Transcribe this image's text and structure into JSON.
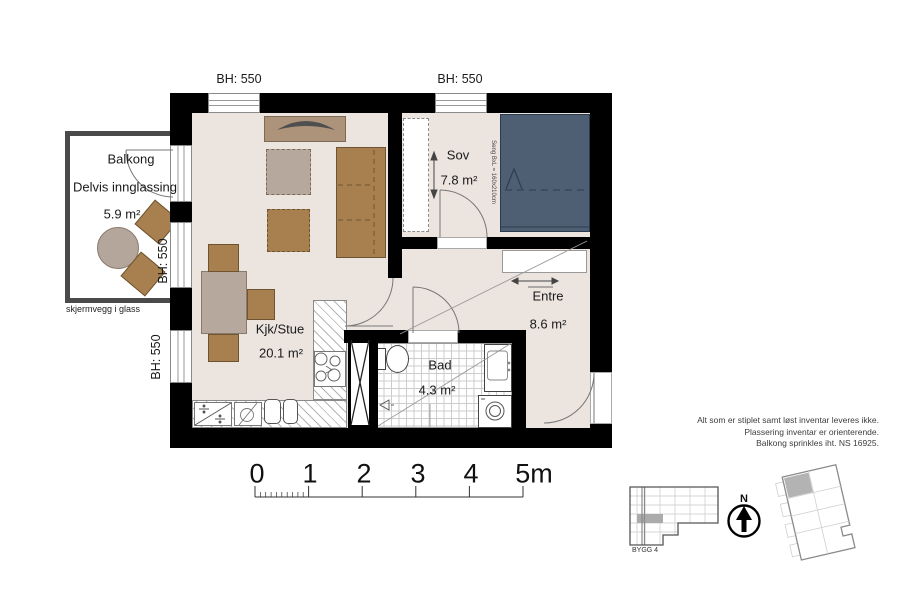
{
  "rooms": {
    "balkong": {
      "name": "Balkong",
      "detail": "Delvis innglassing",
      "area": "5.9 m²"
    },
    "sov": {
      "name": "Sov",
      "area": "7.8 m²"
    },
    "kjk_stue": {
      "name": "Kjk/Stue",
      "area": "20.1 m²"
    },
    "entre": {
      "name": "Entre",
      "area": "8.6 m²"
    },
    "bad": {
      "name": "Bad",
      "area": "4.3 m²"
    }
  },
  "labels": {
    "bh_window_top_left": "BH: 550",
    "bh_window_top_right": "BH: 550",
    "bh_balcony_door": "BH: 550",
    "bh_window_left": "BH: 550",
    "screen_wall": "skjermvegg i glass",
    "bed_size": "Seng BxL = 160x210cm"
  },
  "scale_bar": {
    "ticks": [
      "0",
      "1",
      "2",
      "3",
      "4",
      "5m"
    ]
  },
  "notes": {
    "line1": "Alt som er stiplet samt løst inventar leveres ikke.",
    "line2": "Plassering inventar er orienterende.",
    "line3": "Balkong sprinkles iht. NS 16925."
  },
  "locator": {
    "building": "BYGG 4",
    "north": "N"
  },
  "colors": {
    "wall": "#000000",
    "floor": "#ece4df",
    "bed": "#4e5f73",
    "furniture_wood": "#a8804f",
    "furniture_tan": "#b7a89d",
    "balcony_railing": "#4a4a4a"
  }
}
